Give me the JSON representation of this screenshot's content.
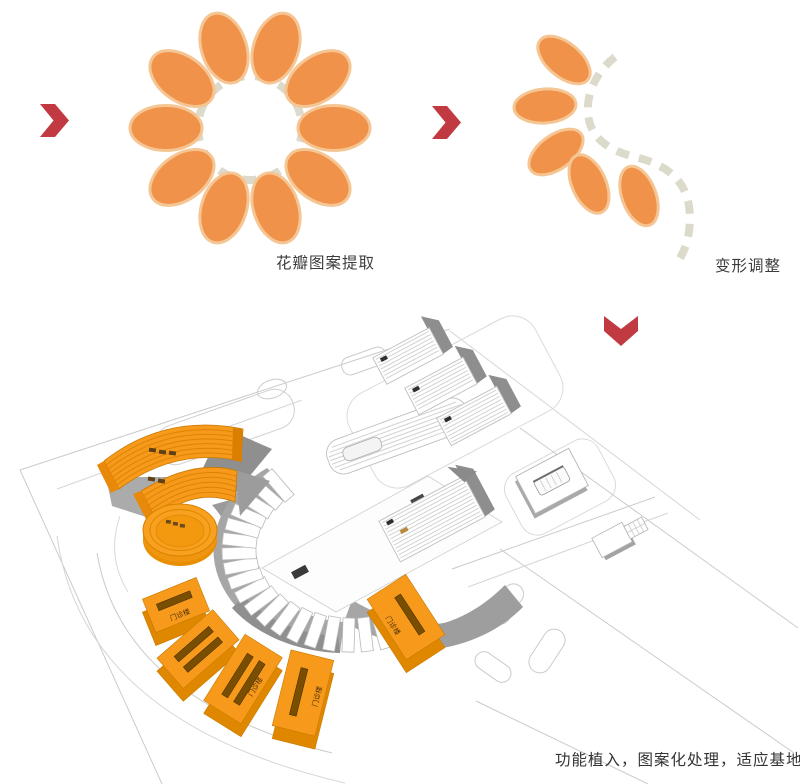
{
  "captions": {
    "step1": "花瓣图案提取",
    "step2": "变形调整",
    "step3": "功能植入，图案化处理，适应基地"
  },
  "model": {
    "wedge_label": "门诊楼"
  },
  "flower": {
    "petal_count": 10
  },
  "deformed_flower": {
    "petal_count": 5
  },
  "colors": {
    "petal_fill": "#F0924A",
    "petal_outline": "#F5C693",
    "dash_gray": "#DCDACB",
    "arrow_red": "#C13A41",
    "building_orange": "#F79A1B",
    "building_orange_dark": "#E08700",
    "building_orange_edge": "#C97A00",
    "slot_dark": "#7A4E00",
    "podium_gray": "#A6A6A6",
    "podium_gray_dark": "#8F8F8F",
    "white_building_line": "#D2D2D2",
    "road_line": "#CBCBCB",
    "label_dark": "#4A2F05",
    "text": "#3C3C3C"
  }
}
